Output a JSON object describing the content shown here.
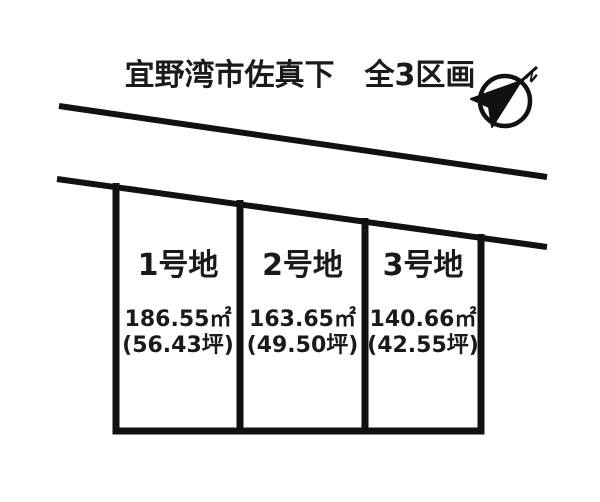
{
  "page": {
    "background_color": "#ffffff",
    "ink_color": "#1a1a1a"
  },
  "header": {
    "title": "宜野湾市佐真下　全3区画"
  },
  "compass": {
    "label": "N"
  },
  "plots": [
    {
      "name": "1号地",
      "area_m2": "186.55㎡",
      "area_tsubo": "(56.43坪)"
    },
    {
      "name": "2号地",
      "area_m2": "163.65㎡",
      "area_tsubo": "(49.50坪)"
    },
    {
      "name": "3号地",
      "area_m2": "140.66㎡",
      "area_tsubo": "(42.55坪)"
    }
  ]
}
